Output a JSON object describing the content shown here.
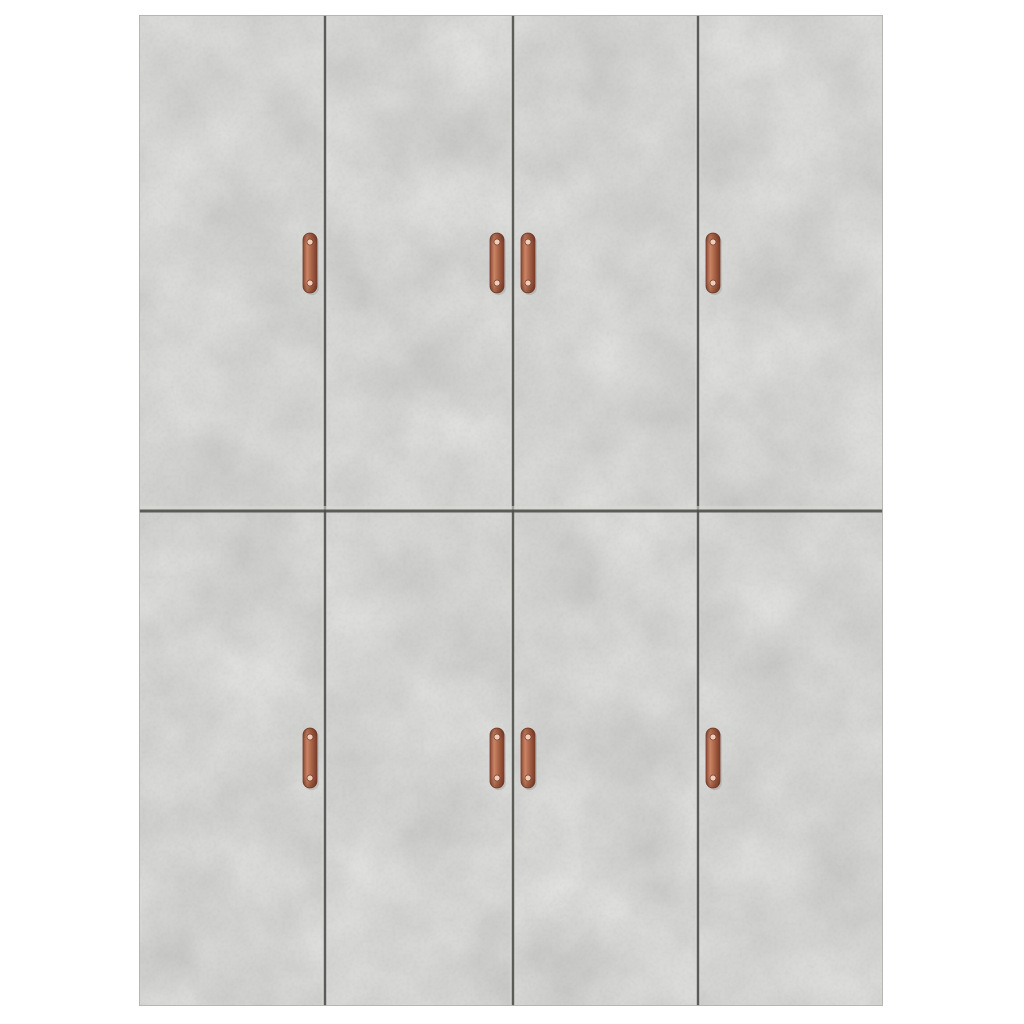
{
  "scene": {
    "description": "Product photo of an eight-door wardrobe front in concrete grey with copper pull handles, centered on a plain white background",
    "background_color": "#ffffff"
  },
  "cabinet": {
    "x": 139,
    "y": 15,
    "width": 744,
    "height": 991,
    "rows": 2,
    "columns": 4,
    "column_seams_x": [
      186,
      374,
      559
    ],
    "row_seam_y": 496,
    "base_color": "#c6c7c4",
    "texture_light_color": "#e2e3df",
    "texture_dark_color": "#a9aaa6",
    "seam_color": "#50514d",
    "seam_highlight_color": "#d8d9d6",
    "edge_color": "#b2b3b0",
    "doors": [
      {
        "id": "door-top-1",
        "row": 0,
        "col": 0,
        "handle_side": "right"
      },
      {
        "id": "door-top-2",
        "row": 0,
        "col": 1,
        "handle_side": "right"
      },
      {
        "id": "door-top-3",
        "row": 0,
        "col": 2,
        "handle_side": "left"
      },
      {
        "id": "door-top-4",
        "row": 0,
        "col": 3,
        "handle_side": "left"
      },
      {
        "id": "door-bottom-1",
        "row": 1,
        "col": 0,
        "handle_side": "right"
      },
      {
        "id": "door-bottom-2",
        "row": 1,
        "col": 1,
        "handle_side": "right"
      },
      {
        "id": "door-bottom-3",
        "row": 1,
        "col": 2,
        "handle_side": "left"
      },
      {
        "id": "door-bottom-4",
        "row": 1,
        "col": 3,
        "handle_side": "left"
      }
    ]
  },
  "handles": {
    "count": 8,
    "width": 14,
    "height": 60,
    "corner_radius": 7,
    "body_color": "#b06a4c",
    "body_light": "#c98566",
    "body_edge": "#8a4a34",
    "body_dark": "#7a3b28",
    "screw_color": "#eecdbb",
    "screw_offset_top": 9,
    "screw_offset_bottom": 10,
    "screw_radius": 3,
    "positions": [
      {
        "door": "door-top-1",
        "x": 164,
        "y": 218
      },
      {
        "door": "door-top-2",
        "x": 351,
        "y": 218
      },
      {
        "door": "door-top-3",
        "x": 382,
        "y": 218
      },
      {
        "door": "door-top-4",
        "x": 567,
        "y": 218
      },
      {
        "door": "door-bottom-1",
        "x": 164,
        "y": 713
      },
      {
        "door": "door-bottom-2",
        "x": 351,
        "y": 713
      },
      {
        "door": "door-bottom-3",
        "x": 382,
        "y": 713
      },
      {
        "door": "door-bottom-4",
        "x": 567,
        "y": 713
      }
    ]
  }
}
